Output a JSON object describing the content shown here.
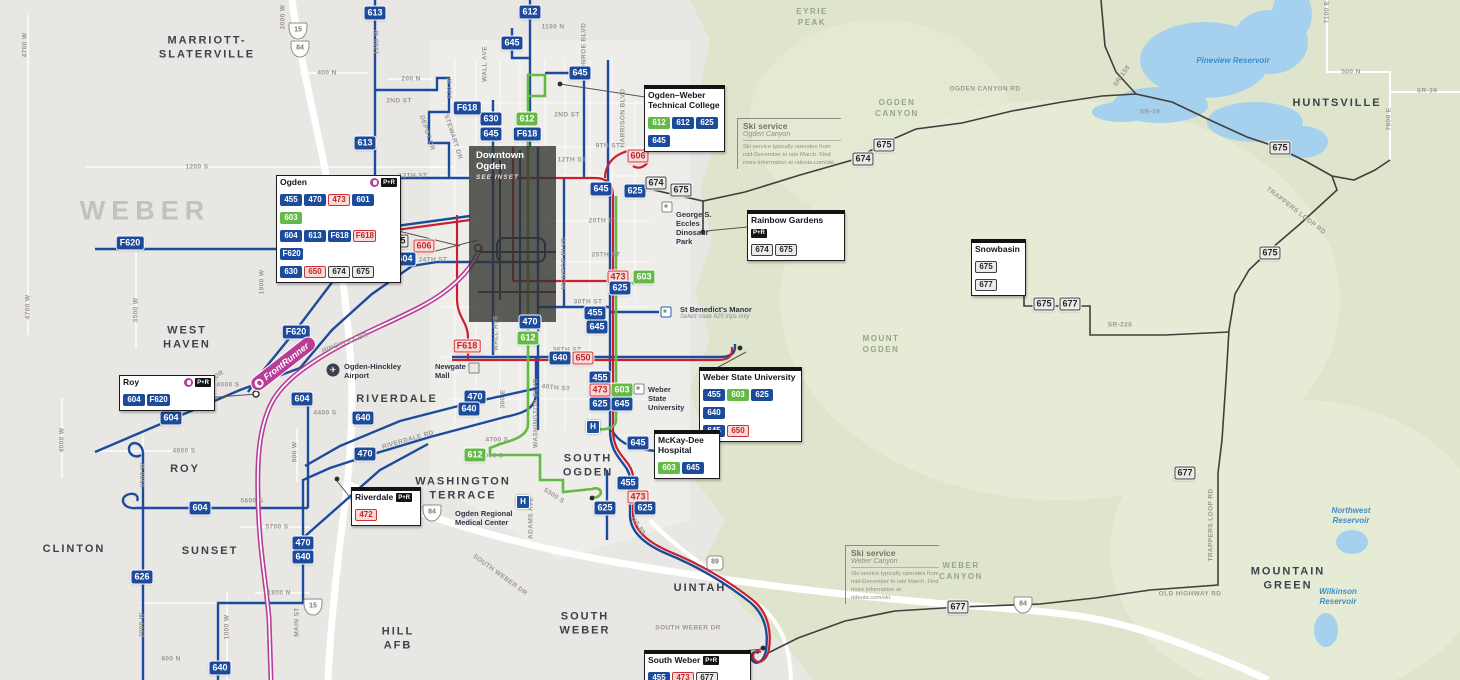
{
  "colors": {
    "route_blue": "#1c4b9c",
    "route_green": "#64ba46",
    "route_red": "#c8202f",
    "pink_badge_bg": "#f9dad6",
    "pink_badge_text": "#bf272d",
    "gray_badge_bg": "#edebe7",
    "frontrunner_magenta": "#b93d97",
    "mountain_route": "#3f3f3d",
    "terrain_green": "#dfe5cc",
    "water_blue": "#a5d1ee",
    "inset_overlay": "#343432",
    "city_text": "#3c424b",
    "street_text": "#9b9893"
  },
  "inset": {
    "line1": "Downtown",
    "line2": "Ogden",
    "note": "SEE INSET"
  },
  "frontrunner": {
    "label": "FrontRunner"
  },
  "county_labels": [
    {
      "text": "WEBER",
      "x": 145,
      "y": 211
    }
  ],
  "city_labels": [
    {
      "text": "MARRIOTT-\nSLATERVILLE",
      "x": 207,
      "y": 48
    },
    {
      "text": "WEST\nHAVEN",
      "x": 187,
      "y": 338
    },
    {
      "text": "ROY",
      "x": 185,
      "y": 469
    },
    {
      "text": "CLINTON",
      "x": 74,
      "y": 549
    },
    {
      "text": "SUNSET",
      "x": 210,
      "y": 551
    },
    {
      "text": "RIVERDALE",
      "x": 397,
      "y": 399
    },
    {
      "text": "WASHINGTON\nTERRACE",
      "x": 463,
      "y": 489
    },
    {
      "text": "SOUTH\nOGDEN",
      "x": 588,
      "y": 466
    },
    {
      "text": "UINTAH",
      "x": 700,
      "y": 588
    },
    {
      "text": "SOUTH\nWEBER",
      "x": 585,
      "y": 624
    },
    {
      "text": "HILL\nAFB",
      "x": 398,
      "y": 639
    },
    {
      "text": "HUNTSVILLE",
      "x": 1337,
      "y": 103
    },
    {
      "text": "MOUNTAIN\nGREEN",
      "x": 1288,
      "y": 579
    }
  ],
  "region_labels": [
    {
      "text": "EYRIE\nPEAK",
      "x": 812,
      "y": 18
    },
    {
      "text": "OGDEN\nCANYON",
      "x": 897,
      "y": 109
    },
    {
      "text": "MOUNT\nOGDEN",
      "x": 881,
      "y": 345
    },
    {
      "text": "WEBER\nCANYON",
      "x": 961,
      "y": 572
    }
  ],
  "water_labels": [
    {
      "text": "Pineview Reservoir",
      "x": 1233,
      "y": 61
    },
    {
      "text": "Northwest\nReservoir",
      "x": 1351,
      "y": 516
    },
    {
      "text": "Wilkinson\nReservoir",
      "x": 1338,
      "y": 597
    }
  ],
  "street_labels": [
    {
      "text": "1200 S",
      "x": 197,
      "y": 167
    },
    {
      "text": "4700 W",
      "x": 25,
      "y": 45,
      "r": -90
    },
    {
      "text": "2000 W",
      "x": 283,
      "y": 17,
      "r": -90
    },
    {
      "text": "1200 W",
      "x": 377,
      "y": 42,
      "r": -90
    },
    {
      "text": "400 N",
      "x": 327,
      "y": 73
    },
    {
      "text": "200 N",
      "x": 411,
      "y": 79
    },
    {
      "text": "2ND ST",
      "x": 399,
      "y": 101
    },
    {
      "text": "530 W",
      "x": 450,
      "y": 88,
      "r": -90
    },
    {
      "text": "DEPOT DR",
      "x": 427,
      "y": 133,
      "r": 72
    },
    {
      "text": "STEWART DR",
      "x": 453,
      "y": 137,
      "r": 72
    },
    {
      "text": "WALL AVE",
      "x": 485,
      "y": 64,
      "r": -90
    },
    {
      "text": "WALL AVE",
      "x": 496,
      "y": 333,
      "r": -90
    },
    {
      "text": "MONROE BLVD",
      "x": 584,
      "y": 49,
      "r": -90
    },
    {
      "text": "MONROE BLVD",
      "x": 564,
      "y": 263,
      "r": -90
    },
    {
      "text": "HARRISON BLVD",
      "x": 623,
      "y": 118,
      "r": -90
    },
    {
      "text": "WASHINGTON BLVD",
      "x": 536,
      "y": 413,
      "r": -90
    },
    {
      "text": "1100 N",
      "x": 553,
      "y": 27
    },
    {
      "text": "2ND ST",
      "x": 567,
      "y": 115
    },
    {
      "text": "9TH ST",
      "x": 608,
      "y": 146
    },
    {
      "text": "12TH ST",
      "x": 413,
      "y": 176
    },
    {
      "text": "12TH ST",
      "x": 572,
      "y": 160
    },
    {
      "text": "20TH ST",
      "x": 603,
      "y": 221
    },
    {
      "text": "21ST ST",
      "x": 338,
      "y": 221,
      "r": -8
    },
    {
      "text": "WILSON LN",
      "x": 330,
      "y": 240
    },
    {
      "text": "2550 S",
      "x": 336,
      "y": 260
    },
    {
      "text": "24TH ST",
      "x": 433,
      "y": 260
    },
    {
      "text": "25TH ST",
      "x": 606,
      "y": 255
    },
    {
      "text": "30TH ST",
      "x": 588,
      "y": 302
    },
    {
      "text": "36TH ST",
      "x": 567,
      "y": 350
    },
    {
      "text": "40TH ST",
      "x": 556,
      "y": 388,
      "r": 6
    },
    {
      "text": "4700 S",
      "x": 497,
      "y": 440
    },
    {
      "text": "RIVERDALE RD",
      "x": 408,
      "y": 440,
      "r": -16
    },
    {
      "text": "5000 S",
      "x": 492,
      "y": 456
    },
    {
      "text": "5300 S",
      "x": 554,
      "y": 496,
      "r": 33
    },
    {
      "text": "ADAMS AVE",
      "x": 531,
      "y": 518,
      "r": -90
    },
    {
      "text": "US-89",
      "x": 638,
      "y": 526,
      "r": 55
    },
    {
      "text": "SOUTH WEBER DR",
      "x": 500,
      "y": 575,
      "r": 36
    },
    {
      "text": "SOUTH WEBER DR",
      "x": 688,
      "y": 628
    },
    {
      "text": "HINCKLEY DR",
      "x": 345,
      "y": 343,
      "r": -20
    },
    {
      "text": "MIDLAND DR",
      "x": 205,
      "y": 385,
      "r": -36
    },
    {
      "text": "4000 S",
      "x": 228,
      "y": 385
    },
    {
      "text": "4400 S",
      "x": 325,
      "y": 413
    },
    {
      "text": "4800 S",
      "x": 184,
      "y": 451
    },
    {
      "text": "3500 W",
      "x": 136,
      "y": 310,
      "r": -90
    },
    {
      "text": "4700 W",
      "x": 28,
      "y": 307,
      "r": -90
    },
    {
      "text": "4000 W",
      "x": 62,
      "y": 440,
      "r": -90
    },
    {
      "text": "900 W",
      "x": 295,
      "y": 452,
      "r": -90
    },
    {
      "text": "3500 W",
      "x": 143,
      "y": 475,
      "r": -90
    },
    {
      "text": "1900 W",
      "x": 262,
      "y": 282,
      "r": -90
    },
    {
      "text": "5600 S",
      "x": 252,
      "y": 501
    },
    {
      "text": "5700 S",
      "x": 277,
      "y": 527
    },
    {
      "text": "2000 W",
      "x": 142,
      "y": 625,
      "r": -90
    },
    {
      "text": "1000 W",
      "x": 227,
      "y": 627,
      "r": -90
    },
    {
      "text": "MAIN ST",
      "x": 297,
      "y": 622,
      "r": -90
    },
    {
      "text": "1800 N",
      "x": 279,
      "y": 593
    },
    {
      "text": "800 N",
      "x": 171,
      "y": 659
    },
    {
      "text": "300 E",
      "x": 503,
      "y": 399,
      "r": -90
    },
    {
      "text": "OGDEN CANYON RD",
      "x": 985,
      "y": 89
    },
    {
      "text": "SR-158",
      "x": 1122,
      "y": 76,
      "r": -55
    },
    {
      "text": "SR-39",
      "x": 1150,
      "y": 112
    },
    {
      "text": "SR-39",
      "x": 1427,
      "y": 91
    },
    {
      "text": "500 N",
      "x": 1351,
      "y": 72
    },
    {
      "text": "7100 E",
      "x": 1327,
      "y": 12,
      "r": -90
    },
    {
      "text": "7800 E",
      "x": 1389,
      "y": 119,
      "r": -90
    },
    {
      "text": "SR-226",
      "x": 1120,
      "y": 325
    },
    {
      "text": "TRAPPERS LOOP RD",
      "x": 1296,
      "y": 211,
      "r": 38
    },
    {
      "text": "TRAPPERS LOOP RD",
      "x": 1211,
      "y": 525,
      "r": -90
    },
    {
      "text": "OLD HIGHWAY RD",
      "x": 1190,
      "y": 594
    }
  ],
  "route_badges": [
    {
      "r": "613",
      "s": "blue",
      "x": 375,
      "y": 13
    },
    {
      "r": "612",
      "s": "blue",
      "x": 530,
      "y": 12
    },
    {
      "r": "645",
      "s": "blue",
      "x": 512,
      "y": 43
    },
    {
      "r": "645",
      "s": "blue",
      "x": 580,
      "y": 73
    },
    {
      "r": "630",
      "s": "blue",
      "x": 491,
      "y": 119
    },
    {
      "r": "645",
      "s": "blue",
      "x": 491,
      "y": 134
    },
    {
      "r": "612",
      "s": "green",
      "x": 527,
      "y": 119
    },
    {
      "r": "F618",
      "s": "blue",
      "x": 527,
      "y": 134
    },
    {
      "r": "613",
      "s": "blue",
      "x": 365,
      "y": 143
    },
    {
      "r": "F618",
      "s": "blue",
      "x": 467,
      "y": 108
    },
    {
      "r": "606",
      "s": "pink",
      "x": 638,
      "y": 156
    },
    {
      "r": "645",
      "s": "blue",
      "x": 601,
      "y": 189
    },
    {
      "r": "625",
      "s": "blue",
      "x": 635,
      "y": 191
    },
    {
      "r": "674",
      "s": "gray",
      "x": 656,
      "y": 183
    },
    {
      "r": "675",
      "s": "gray",
      "x": 681,
      "y": 190
    },
    {
      "r": "675",
      "s": "gray",
      "x": 398,
      "y": 241
    },
    {
      "r": "606",
      "s": "pink",
      "x": 424,
      "y": 246
    },
    {
      "r": "F620",
      "s": "blue",
      "x": 130,
      "y": 243
    },
    {
      "r": "F620",
      "s": "blue",
      "x": 304,
      "y": 250
    },
    {
      "r": "604",
      "s": "blue",
      "x": 405,
      "y": 259
    },
    {
      "r": "F620",
      "s": "blue",
      "x": 296,
      "y": 332
    },
    {
      "r": "473",
      "s": "pink",
      "x": 618,
      "y": 277
    },
    {
      "r": "603",
      "s": "green",
      "x": 644,
      "y": 277
    },
    {
      "r": "625",
      "s": "blue",
      "x": 620,
      "y": 288
    },
    {
      "r": "455",
      "s": "blue",
      "x": 595,
      "y": 313
    },
    {
      "r": "645",
      "s": "blue",
      "x": 597,
      "y": 327
    },
    {
      "r": "470",
      "s": "blue",
      "x": 530,
      "y": 322
    },
    {
      "r": "612",
      "s": "green",
      "x": 528,
      "y": 338
    },
    {
      "r": "F618",
      "s": "pink",
      "x": 467,
      "y": 346
    },
    {
      "r": "640",
      "s": "blue",
      "x": 560,
      "y": 358
    },
    {
      "r": "650",
      "s": "pink",
      "x": 583,
      "y": 358
    },
    {
      "r": "455",
      "s": "blue",
      "x": 600,
      "y": 378
    },
    {
      "r": "473",
      "s": "pink",
      "x": 600,
      "y": 390
    },
    {
      "r": "603",
      "s": "green",
      "x": 622,
      "y": 390
    },
    {
      "r": "625",
      "s": "blue",
      "x": 600,
      "y": 404
    },
    {
      "r": "645",
      "s": "blue",
      "x": 622,
      "y": 404
    },
    {
      "r": "470",
      "s": "blue",
      "x": 475,
      "y": 397
    },
    {
      "r": "640",
      "s": "blue",
      "x": 469,
      "y": 409
    },
    {
      "r": "604",
      "s": "blue",
      "x": 171,
      "y": 418
    },
    {
      "r": "604",
      "s": "blue",
      "x": 302,
      "y": 399
    },
    {
      "r": "640",
      "s": "blue",
      "x": 363,
      "y": 418
    },
    {
      "r": "470",
      "s": "blue",
      "x": 365,
      "y": 454
    },
    {
      "r": "612",
      "s": "green",
      "x": 475,
      "y": 455
    },
    {
      "r": "645",
      "s": "blue",
      "x": 638,
      "y": 443
    },
    {
      "r": "455",
      "s": "blue",
      "x": 628,
      "y": 483
    },
    {
      "r": "473",
      "s": "pink",
      "x": 638,
      "y": 497
    },
    {
      "r": "625",
      "s": "blue",
      "x": 605,
      "y": 508
    },
    {
      "r": "625",
      "s": "blue",
      "x": 645,
      "y": 508
    },
    {
      "r": "604",
      "s": "blue",
      "x": 200,
      "y": 508
    },
    {
      "r": "626",
      "s": "blue",
      "x": 142,
      "y": 577
    },
    {
      "r": "470",
      "s": "blue",
      "x": 303,
      "y": 543
    },
    {
      "r": "640",
      "s": "blue",
      "x": 303,
      "y": 557
    },
    {
      "r": "640",
      "s": "blue",
      "x": 220,
      "y": 668
    },
    {
      "r": "674",
      "s": "gray",
      "x": 863,
      "y": 159
    },
    {
      "r": "675",
      "s": "gray",
      "x": 884,
      "y": 145
    },
    {
      "r": "675",
      "s": "gray",
      "x": 1280,
      "y": 148
    },
    {
      "r": "675",
      "s": "gray",
      "x": 1270,
      "y": 253
    },
    {
      "r": "675",
      "s": "gray",
      "x": 1044,
      "y": 304
    },
    {
      "r": "677",
      "s": "gray",
      "x": 1070,
      "y": 304
    },
    {
      "r": "677",
      "s": "gray",
      "x": 1185,
      "y": 473
    },
    {
      "r": "677",
      "s": "gray",
      "x": 958,
      "y": 607
    }
  ],
  "shields": [
    {
      "kind": "interstate",
      "label": "15",
      "x": 298,
      "y": 31
    },
    {
      "kind": "interstate",
      "label": "84",
      "x": 300,
      "y": 49
    },
    {
      "kind": "interstate",
      "label": "15",
      "x": 313,
      "y": 607
    },
    {
      "kind": "interstate",
      "label": "84",
      "x": 432,
      "y": 513
    },
    {
      "kind": "interstate",
      "label": "84",
      "x": 1023,
      "y": 605
    },
    {
      "kind": "us",
      "label": "89",
      "x": 715,
      "y": 563
    }
  ],
  "callouts": [
    {
      "id": "ogden-station",
      "title": "Ogden",
      "icons": [
        "frontrunner",
        "park-and-ride"
      ],
      "x": 276,
      "y": 175,
      "w": 117,
      "bar": false,
      "rows": [
        [
          {
            "r": "455",
            "s": "blue"
          },
          {
            "r": "470",
            "s": "blue"
          },
          {
            "r": "473",
            "s": "pink"
          },
          {
            "r": "601",
            "s": "blue"
          },
          {
            "r": "603",
            "s": "green"
          }
        ],
        [
          {
            "r": "604",
            "s": "blue"
          },
          {
            "r": "613",
            "s": "blue"
          },
          {
            "r": "F618",
            "s": "blue"
          },
          {
            "r": "F618",
            "s": "pink"
          },
          {
            "r": "F620",
            "s": "blue"
          }
        ],
        [
          {
            "r": "630",
            "s": "blue"
          },
          {
            "r": "650",
            "s": "pink"
          },
          {
            "r": "674",
            "s": "gray"
          },
          {
            "r": "675",
            "s": "gray"
          }
        ]
      ]
    },
    {
      "id": "ogden-weber-technical-college",
      "title": "Ogden–Weber Technical College",
      "x": 644,
      "y": 85,
      "w": 73,
      "bar": true,
      "rows": [
        [
          {
            "r": "612",
            "s": "green"
          },
          {
            "r": "612",
            "s": "blue"
          },
          {
            "r": "625",
            "s": "blue"
          }
        ],
        [
          {
            "r": "645",
            "s": "blue"
          }
        ]
      ]
    },
    {
      "id": "rainbow-gardens",
      "title": "Rainbow Gardens",
      "pr": true,
      "x": 747,
      "y": 210,
      "w": 90,
      "bar": true,
      "rows": [
        [
          {
            "r": "674",
            "s": "gray"
          },
          {
            "r": "675",
            "s": "gray"
          }
        ]
      ]
    },
    {
      "id": "snowbasin",
      "title": "Snowbasin",
      "x": 971,
      "y": 239,
      "w": 47,
      "bar": true,
      "rows": [
        [
          {
            "r": "675",
            "s": "gray"
          },
          {
            "r": "677",
            "s": "gray"
          }
        ]
      ]
    },
    {
      "id": "weber-state-university",
      "title": "Weber State University",
      "x": 699,
      "y": 367,
      "w": 95,
      "bar": true,
      "rows": [
        [
          {
            "r": "455",
            "s": "blue"
          },
          {
            "r": "603",
            "s": "green"
          },
          {
            "r": "625",
            "s": "blue"
          },
          {
            "r": "640",
            "s": "blue"
          }
        ],
        [
          {
            "r": "645",
            "s": "blue"
          },
          {
            "r": "650",
            "s": "pink"
          }
        ]
      ]
    },
    {
      "id": "mckay-dee-hospital",
      "title": "McKay-Dee Hospital",
      "x": 654,
      "y": 430,
      "w": 58,
      "bar": true,
      "rows": [
        [
          {
            "r": "603",
            "s": "green"
          },
          {
            "r": "645",
            "s": "blue"
          }
        ]
      ]
    },
    {
      "id": "riverdale",
      "title": "Riverdale",
      "pr": true,
      "x": 351,
      "y": 487,
      "w": 62,
      "bar": true,
      "rows": [
        [
          {
            "r": "472",
            "s": "pink"
          }
        ]
      ]
    },
    {
      "id": "roy-station",
      "title": "Roy",
      "icons": [
        "frontrunner",
        "park-and-ride"
      ],
      "x": 119,
      "y": 375,
      "w": 88,
      "bar": false,
      "rows": [
        [
          {
            "r": "604",
            "s": "blue"
          },
          {
            "r": "F620",
            "s": "blue"
          }
        ]
      ]
    },
    {
      "id": "south-weber",
      "title": "South Weber",
      "pr": true,
      "x": 644,
      "y": 650,
      "w": 99,
      "bar": true,
      "rows": [
        [
          {
            "r": "455",
            "s": "blue"
          },
          {
            "r": "473",
            "s": "pink"
          },
          {
            "r": "677",
            "s": "gray"
          }
        ]
      ]
    }
  ],
  "ski_notes": [
    {
      "title": "Ski service",
      "subtitle": "Ogden Canyon",
      "x": 737,
      "y": 118,
      "w": 98,
      "body": "Ski service typically operates from mid-December to late March. Find more information at rideuta.com/ski."
    },
    {
      "title": "Ski service",
      "subtitle": "Weber Canyon",
      "x": 845,
      "y": 545,
      "w": 88,
      "body": "Ski service typically operates from mid-December to late March. Find more information at rideuta.com/ski."
    }
  ],
  "pois": [
    {
      "icon": "airplane-icon",
      "glyph": "✈",
      "x": 333,
      "y": 370,
      "text": "Ogden-Hinckley\nAirport",
      "tx": 344,
      "ty": 362
    },
    {
      "icon": "mall-icon",
      "x": 474,
      "y": 368,
      "text": "Newgate\nMall",
      "tx": 435,
      "ty": 362
    },
    {
      "icon": "stop-gray-icon",
      "x": 667,
      "y": 207,
      "text": "George S.\nEccles\nDinosaur\nPark",
      "tx": 676,
      "ty": 210
    },
    {
      "icon": "stop-blue-icon",
      "x": 666,
      "y": 312,
      "text": "St Benedict's Manor",
      "sub": "Select route 625 trips only",
      "tx": 680,
      "ty": 305
    },
    {
      "icon": "stop-gray-icon",
      "x": 639,
      "y": 389,
      "text": "Weber\nState\nUniversity",
      "tx": 648,
      "ty": 385
    },
    {
      "icon": "none",
      "text": "Ogden Regional\nMedical Center",
      "tx": 455,
      "ty": 509
    },
    {
      "icon": "hospital-icon",
      "glyph": "H",
      "x": 593,
      "y": 427
    },
    {
      "icon": "hospital-icon",
      "glyph": "H",
      "x": 523,
      "y": 502
    }
  ]
}
